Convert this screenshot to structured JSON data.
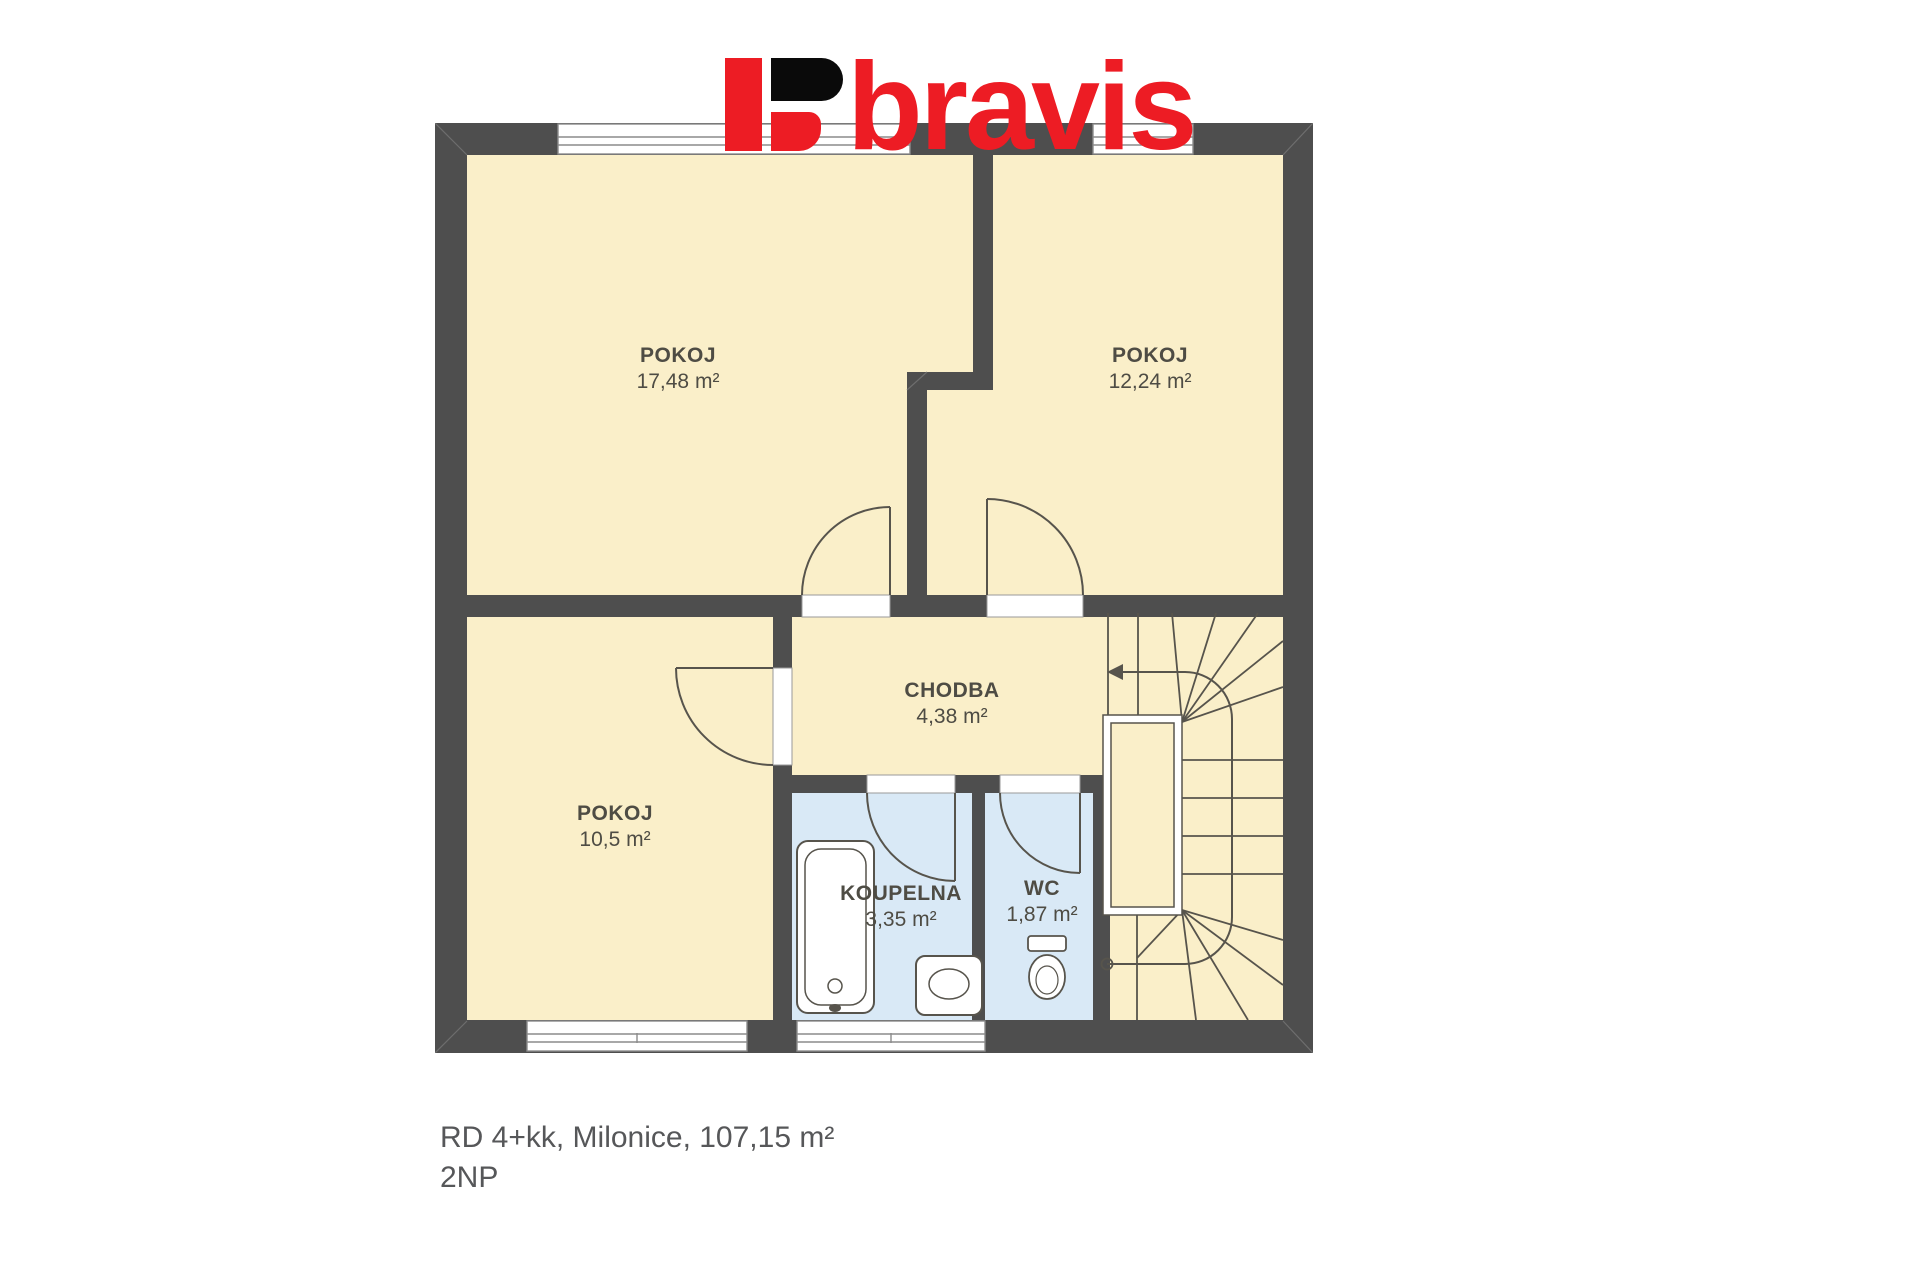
{
  "logo": {
    "text": "bravis",
    "accent_color": "#ED1C24",
    "black_color": "#0a0a0a"
  },
  "rooms": [
    {
      "id": "pokoj-1",
      "name": "POKOJ",
      "area": "17,48 m²"
    },
    {
      "id": "pokoj-2",
      "name": "POKOJ",
      "area": "12,24 m²"
    },
    {
      "id": "chodba",
      "name": "CHODBA",
      "area": "4,38 m²"
    },
    {
      "id": "pokoj-3",
      "name": "POKOJ",
      "area": "10,5 m²"
    },
    {
      "id": "koupelna",
      "name": "KOUPELNA",
      "area": "3,35 m²"
    },
    {
      "id": "wc",
      "name": "WC",
      "area": "1,87 m²"
    }
  ],
  "caption": {
    "line1": "RD 4+kk, Milonice, 107,15 m²",
    "line2": "2NP"
  },
  "colors": {
    "wall": "#4e4e4e",
    "room_fill": "#faefc9",
    "wet_room_fill": "#d9e9f6",
    "line": "#57544c",
    "window_line": "#8c8c8c",
    "label_text": "#4e4c44",
    "caption_text": "#565759"
  }
}
